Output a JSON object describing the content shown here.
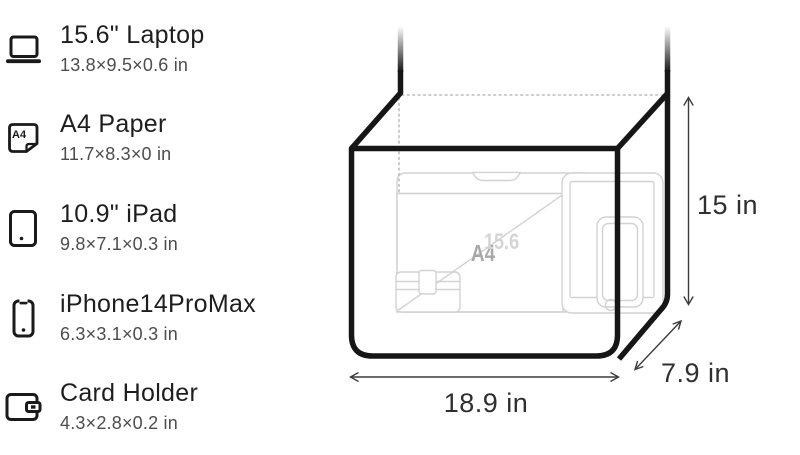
{
  "panel": {
    "items": [
      {
        "icon": "laptop-icon",
        "title": "15.6\" Laptop",
        "dims": "13.8×9.5×0.6 in"
      },
      {
        "icon": "a4-paper-icon",
        "title": "A4 Paper",
        "dims": "11.7×8.3×0 in",
        "icon_label": "A4"
      },
      {
        "icon": "ipad-icon",
        "title": "10.9\" iPad",
        "dims": "9.8×7.1×0.3 in"
      },
      {
        "icon": "iphone-icon",
        "title": "iPhone14ProMax",
        "dims": "6.3×3.1×0.3 in"
      },
      {
        "icon": "card-holder-icon",
        "title": "Card Holder",
        "dims": "4.3×2.8×0.2 in"
      }
    ]
  },
  "diagram": {
    "dimensions": {
      "height": "15 in",
      "width": "18.9 in",
      "depth": "7.9 in"
    },
    "content_labels": {
      "a4": "A4",
      "laptop_diagonal": "15.6"
    },
    "colors": {
      "bag_outline": "#161616",
      "content_outline": "#d2d2d2",
      "dimension_lines": "#3c3c3c",
      "label_a4": "#a8a8a8",
      "label_diagonal": "#d4d4d4"
    }
  }
}
